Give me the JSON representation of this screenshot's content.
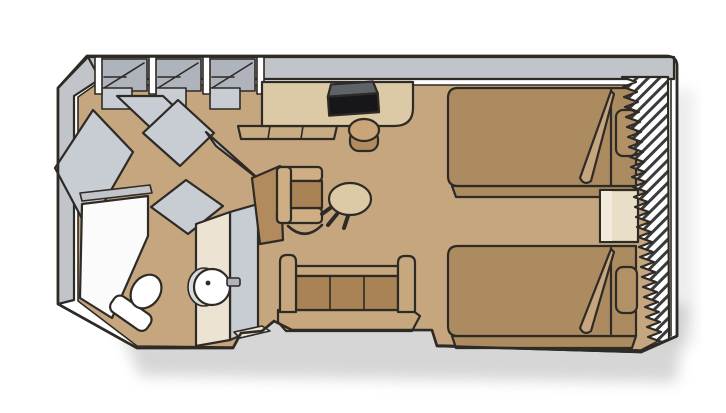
{
  "page": {
    "background": "#ffffff"
  },
  "colors": {
    "outline": "#2e2a25",
    "wall": "#c1c4c9",
    "wall_dark": "#afb4bc",
    "door": "#c8ccd3",
    "floor": "#c5a67e",
    "counter": "#dccaa7",
    "cabinet": "#c9ad82",
    "bed": "#ac8b60",
    "pillow": "#b39166",
    "sofa_frame": "#c7a87e",
    "seat": "#a98256",
    "chair_frame": "#cfae83",
    "chair_shell": "#b18a5e",
    "stool_top": "#c9a577",
    "stool_side": "#b28c60",
    "cream": "#ece3d2",
    "nightstand": "#e9dfc9",
    "nightstand_hi": "#f2ebdc",
    "fixture_white": "#ffffff",
    "shower": "#fbfbfb",
    "tv_top": "#5e6269",
    "tv_front": "#17171a",
    "sink_shadow": "#d8dadc",
    "hatch_stripe": "#3b3b3b",
    "shadow": "#9a9a9a"
  },
  "diagram": {
    "type": "floor-plan",
    "subject": "cruise-ship-stateroom",
    "areas": [
      {
        "name": "wardrobe",
        "items": [
          "closet-bay",
          "closet-bay",
          "closet-bay",
          "open-closet-doors"
        ]
      },
      {
        "name": "bathroom",
        "items": [
          "shower",
          "toilet",
          "sink",
          "bathroom-door",
          "entry-door"
        ]
      },
      {
        "name": "living-area",
        "items": [
          "desk",
          "tv",
          "stool",
          "armchair",
          "side-table",
          "sofa"
        ]
      },
      {
        "name": "sleeping-area",
        "items": [
          "twin-bed-upper",
          "twin-bed-lower",
          "nightstand"
        ]
      },
      {
        "name": "window-wall",
        "items": [
          "drapery-hatch"
        ]
      }
    ]
  }
}
